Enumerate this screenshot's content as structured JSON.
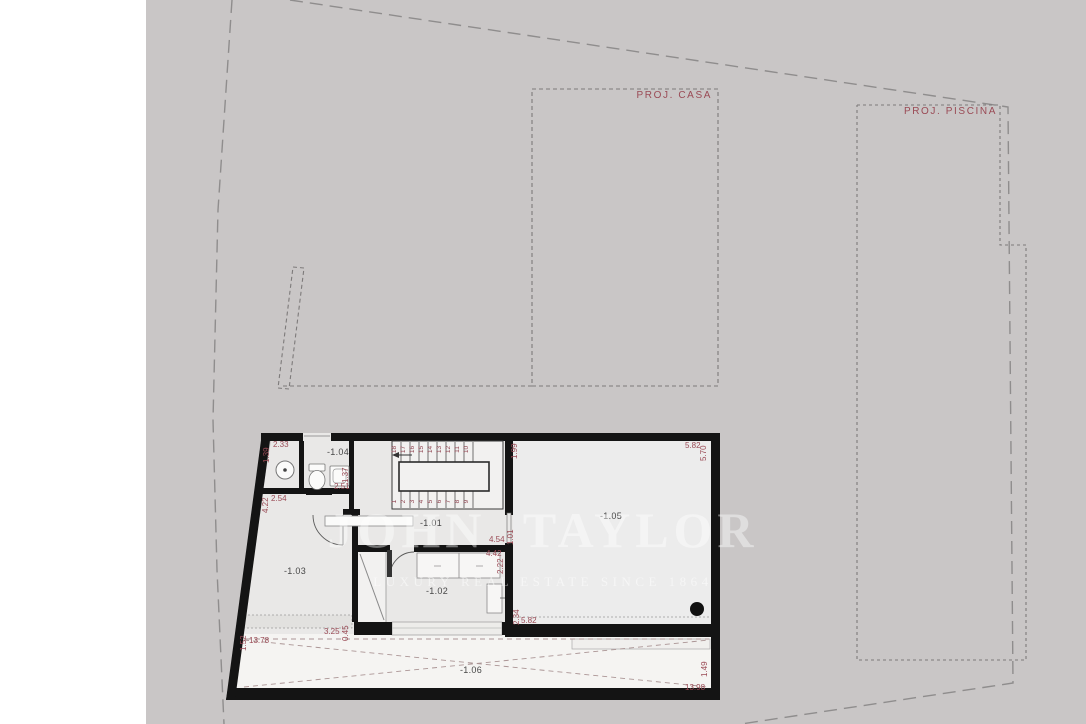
{
  "site_labels": {
    "casa": "PROJ. CASA",
    "piscina": "PROJ. PISCINA"
  },
  "watermark": {
    "brand": "JOHN TAYLOR",
    "tagline": "LUXURY REAL ESTATE SINCE 1864"
  },
  "rooms": {
    "r101": "-1.01",
    "r102": "-1.02",
    "r103": "-1.03",
    "r104": "-1.04",
    "r105": "-1.05",
    "r106": "-1.06"
  },
  "dims": {
    "a233": "2.33",
    "a139": "1.39",
    "a137": "1.37",
    "a251": "2.51",
    "a254": "2.54",
    "a422": "4.22",
    "a199": "1.99",
    "a582t": "5.82",
    "a570": "5.70",
    "a454": "4.54",
    "a101": "1.01",
    "a442": "4.42",
    "a222": "2.22",
    "a234": "2.34",
    "a582m": "5.82",
    "a152": "1.52",
    "a1378": "13.78",
    "a325": "3.25",
    "a045": "0.45",
    "a149": "1.49",
    "a1398": "13.98"
  },
  "stairs": {
    "upper": [
      "18",
      "17",
      "16",
      "15",
      "14",
      "13",
      "12",
      "11",
      "10"
    ],
    "lower": [
      "1",
      "2",
      "3",
      "4",
      "5",
      "6",
      "7",
      "8",
      "9"
    ]
  },
  "colors": {
    "site": "#c9c6c6",
    "wall": "#141414",
    "floor": "#e9e8e7",
    "floor_light": "#ececec",
    "terrace": "#f5f4f2",
    "dimension_text": "#9a4a55",
    "room_text": "#474747",
    "boundary": "#8f8d8d"
  }
}
